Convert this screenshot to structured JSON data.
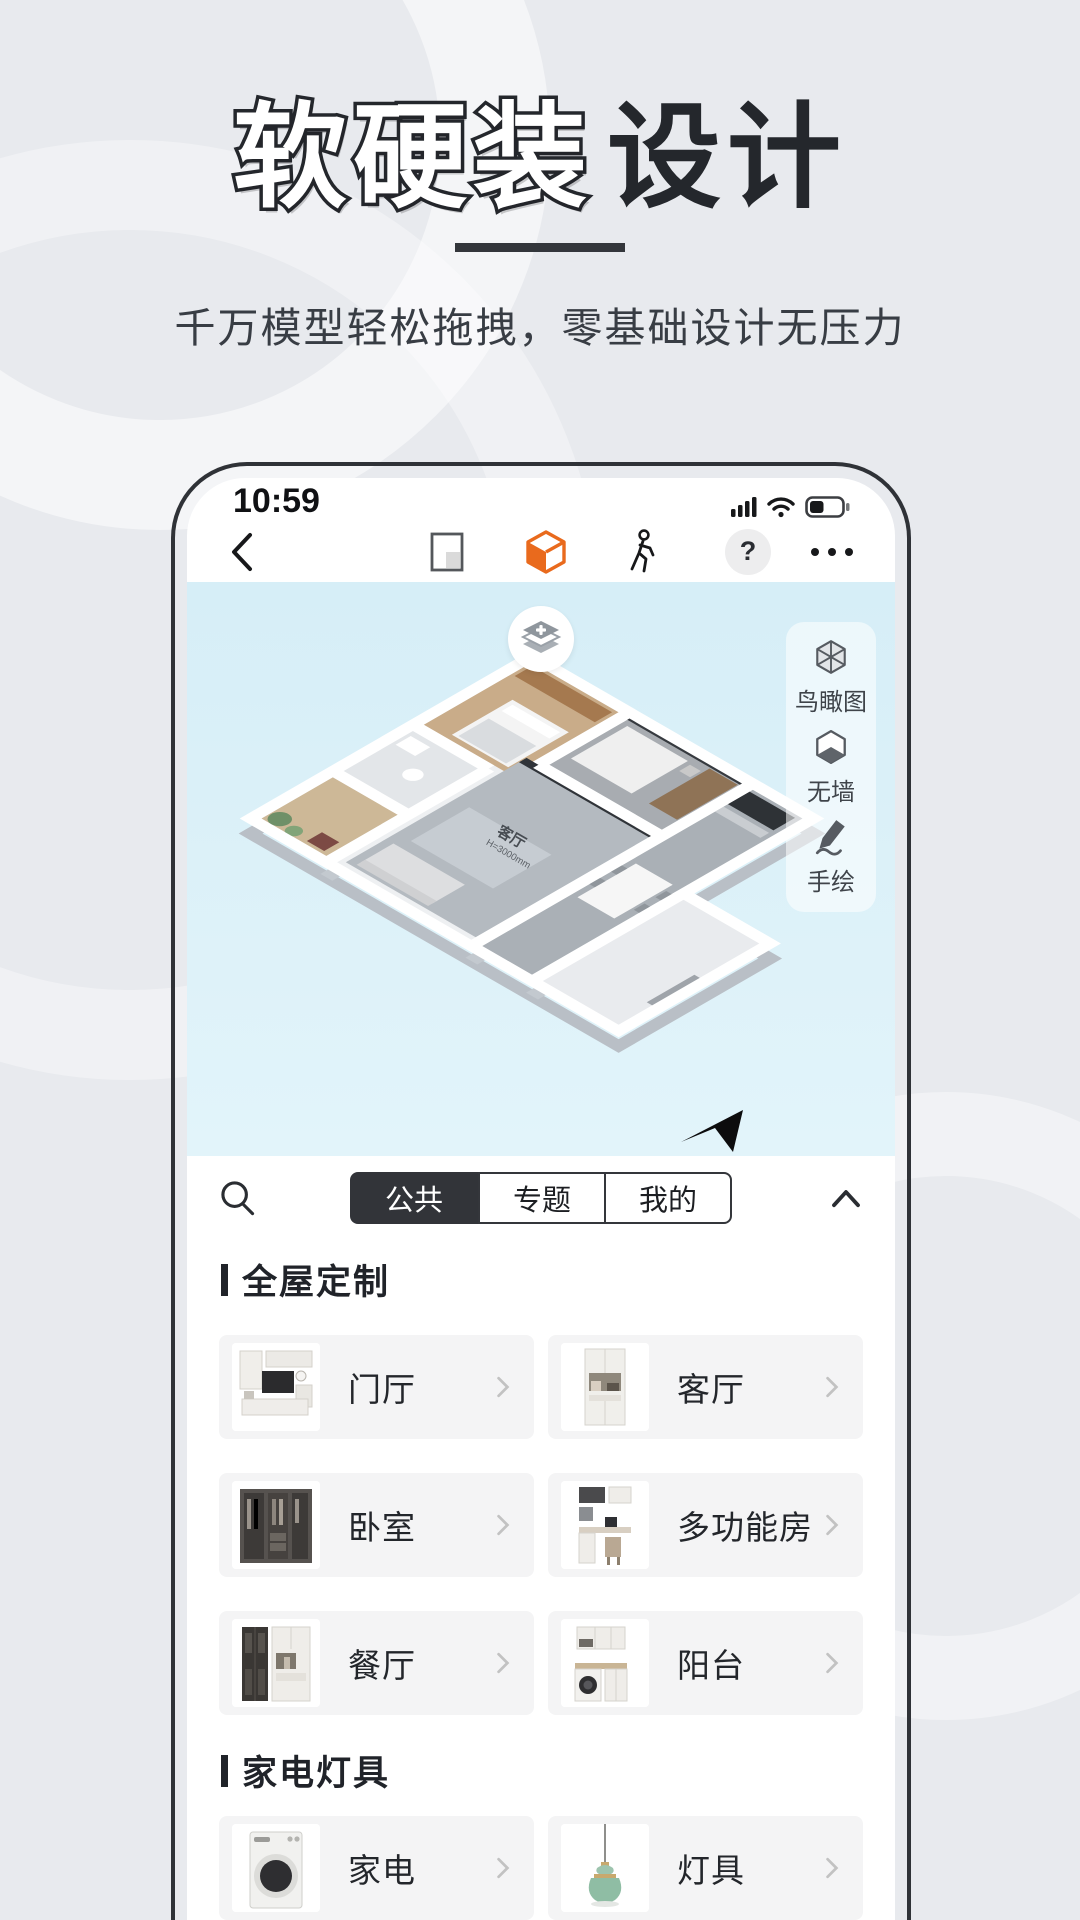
{
  "theme": {
    "page_bg": "#e8eaee",
    "accent_orange": "#e96a1d",
    "sky_blue": "#d9eff7",
    "tab_dark": "#323439",
    "text_dark": "#24272c"
  },
  "hero": {
    "title_outline": "软硬装",
    "title_solid": "设计",
    "subtitle": "千万模型轻松拖拽，零基础设计无压力"
  },
  "phone": {
    "status_bar": {
      "time": "10:59",
      "icons": [
        "signal-icon",
        "wifi-icon",
        "battery-icon"
      ]
    },
    "toolbar": {
      "icons": [
        "back-chevron-icon",
        "floorplan-2d-icon",
        "cube-3d-icon",
        "walkthrough-icon",
        "help-icon",
        "more-dots-icon"
      ],
      "help_label": "?",
      "active_icon": "cube-3d-icon"
    },
    "viewport": {
      "room_label": "客厅",
      "room_height_label": "H=3000mm",
      "overlay_icons": [
        "layers-add-icon",
        "cursor-arrow-icon"
      ],
      "tools": [
        {
          "label": "鸟瞰图",
          "icon": "birdseye-cube-icon"
        },
        {
          "label": "无墙",
          "icon": "nowall-cube-icon"
        },
        {
          "label": "手绘",
          "icon": "draw-pencil-icon"
        }
      ]
    },
    "catalog": {
      "search_icon": "search-icon",
      "collapse_icon": "chevron-up-icon",
      "tabs": [
        {
          "label": "公共",
          "active": true
        },
        {
          "label": "专题",
          "active": false
        },
        {
          "label": "我的",
          "active": false
        }
      ],
      "sections": [
        {
          "title": "全屋定制",
          "items": [
            {
              "label": "门厅",
              "icon": "entry-cabinet"
            },
            {
              "label": "客厅",
              "icon": "living-cabinet"
            },
            {
              "label": "卧室",
              "icon": "wardrobe"
            },
            {
              "label": "多功能房",
              "icon": "multi-room-desk"
            },
            {
              "label": "餐厅",
              "icon": "dining-cabinet"
            },
            {
              "label": "阳台",
              "icon": "balcony-laundry"
            }
          ]
        },
        {
          "title": "家电灯具",
          "items": [
            {
              "label": "家电",
              "icon": "washing-machine"
            },
            {
              "label": "灯具",
              "icon": "pendant-lamp"
            }
          ]
        }
      ]
    }
  }
}
